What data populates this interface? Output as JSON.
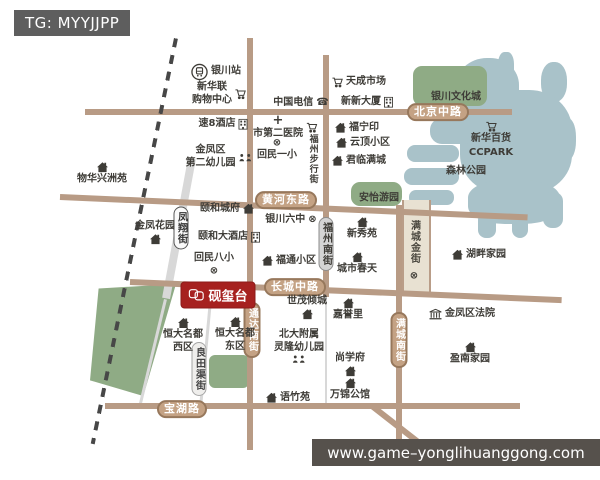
{
  "badge": {
    "text": "TG: MYYJJPP"
  },
  "watermark": {
    "url": "www.game–yonglihuanggong.com"
  },
  "project": {
    "label": "砚玺台",
    "color": "#a6211f"
  },
  "icons": {
    "phone": "☎",
    "school": "⊗",
    "hospital": "+"
  },
  "colors": {
    "road": "#b89b85",
    "road_label_bg": "#c4a284",
    "green": "#8fab85",
    "lake": "#a9c2c9",
    "project_red": "#a6211f"
  },
  "roads": {
    "beijing_middle": "北京中路",
    "huanghe_east": "黄河东路",
    "changcheng_middle": "长城中路",
    "baohu": "宝湖路",
    "tongda_south": "通达南街",
    "fuzhou_south": "福州南街",
    "mancheng_south": "满城南街",
    "mancheng_golden": "满城金街",
    "fengxiang": "凤翔街",
    "liangtianqu": "良田渠街",
    "fuzhou_pedestrian": "福州步行街"
  },
  "areas": {
    "culture_city": "银川文化城",
    "anyi_garden": "安怡游园",
    "forest_park": "森林公园"
  },
  "pois": {
    "yinchuan_station": "银川站",
    "xinhualian_mall": "新华联\n购物中心",
    "su8_hotel": "速8酒店",
    "jinfeng_2nd_kindergarten": "金凤区\n第二幼儿园",
    "wuhua_xingzhouyuan": "物华兴洲苑",
    "china_telecom": "中国电信",
    "second_hospital": "市第二医院",
    "huimin_no1_primary": "回民一小",
    "tiancheng_market": "天成市场",
    "xinxin_building": "新新大厦",
    "funingyin": "福宁印",
    "yunding_xiaoqu": "云顶小区",
    "junlin_mancheng": "君临满城",
    "xinhua_dept": "新华百货",
    "ccpark": "CCPARK",
    "yihe_chengfu": "颐和城府",
    "yinchuan_no6_middle": "银川六中",
    "jinfeng_garden": "金凤花园",
    "yihe_hotel": "颐和大酒店",
    "xinxiu_yuan": "新秀苑",
    "hupan_jiayuan": "湖畔家园",
    "huimin_no8_primary": "回民八小",
    "futong_xiaoqu": "福通小区",
    "chengshi_chuntian": "城市春天",
    "shimao_qingcheng": "世茂倾城",
    "jiayuli": "嘉誉里",
    "jinfeng_court": "金凤区法院",
    "hengda_west": "恒大名都\n西区",
    "hengda_east": "恒大名都\n东区",
    "beida_kindergarten": "北大附属\n灵隆幼儿园",
    "shangxuefu": "尚学府",
    "wanjin_gongguan": "万锦公馆",
    "yuzhuyuan": "语竹苑",
    "yingnan_jiayuan": "盈南家园"
  }
}
